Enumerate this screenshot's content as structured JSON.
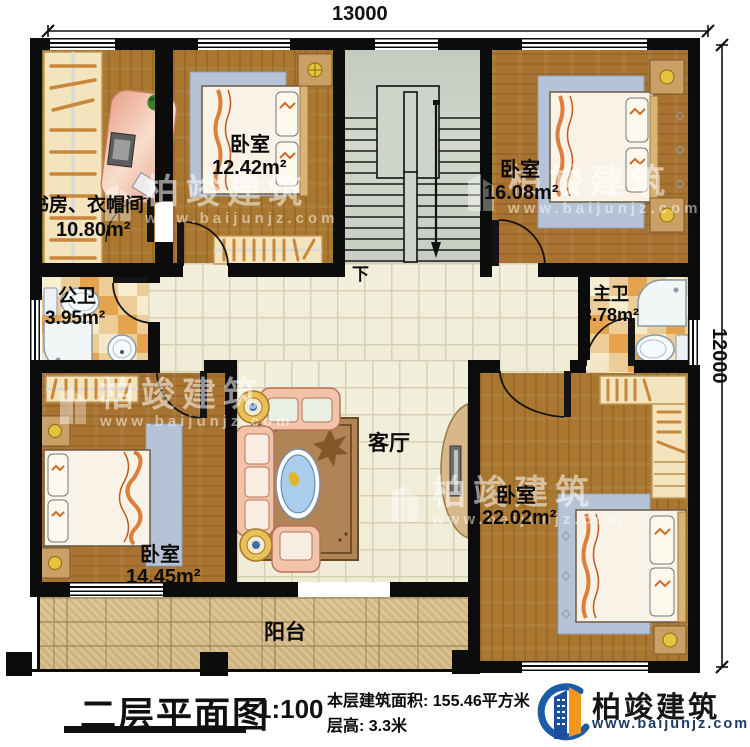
{
  "dimensions": {
    "width_label": "13000",
    "height_label": "12000"
  },
  "stairs": {
    "down_label": "下"
  },
  "rooms": {
    "study": {
      "name": "书房、衣帽间",
      "area": "10.80m²"
    },
    "bedroom_a": {
      "name": "卧室",
      "area": "12.42m²"
    },
    "bedroom_b": {
      "name": "卧室",
      "area": "16.08m²"
    },
    "public_bath": {
      "name": "公卫",
      "area": "3.95m²"
    },
    "master_bath": {
      "name": "主卫",
      "area": "3.78m²"
    },
    "living_room": {
      "name": "客厅"
    },
    "bedroom_c": {
      "name": "卧室",
      "area": "14.45m²"
    },
    "bedroom_d": {
      "name": "卧室",
      "area": "22.02m²"
    },
    "balcony": {
      "name": "阳台"
    }
  },
  "title_block": {
    "title": "二层平面图",
    "scale": "1:100",
    "floor_area": "本层建筑面积: 155.46平方米",
    "floor_height": "层高: 3.3米"
  },
  "brand": {
    "name": "柏竣建筑",
    "website": "www.baijunjz.com"
  },
  "watermark": {
    "name": "柏竣建筑",
    "website": "www.baijunjz.com"
  },
  "colors": {
    "brand_blue": "#1c5ca6",
    "brand_orange": "#f0981d",
    "wall": "#0c0c0c"
  }
}
